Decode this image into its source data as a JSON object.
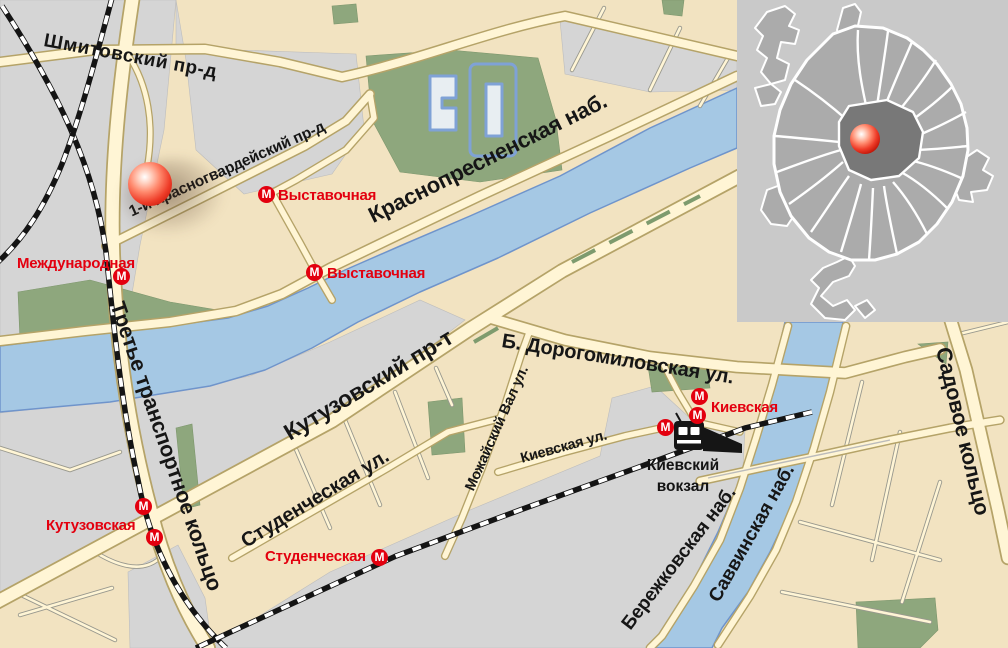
{
  "map": {
    "street_labels": [
      "Шмитовский пр-д",
      "1-й Красногвардейский пр-д",
      "Краснопресненская наб.",
      "Кутузовский пр-т",
      "Б. Дорогомиловская ул.",
      "Студенческая ул.",
      "Можайский Вал ул.",
      "Киевская ул.",
      "Третье транспортное кольцо",
      "Бережковская наб.",
      "Саввинская наб.",
      "Садовое кольцо"
    ],
    "metro": {
      "icon_letter": "М",
      "stations": [
        {
          "name": "Выставочная"
        },
        {
          "name": "Выставочная"
        },
        {
          "name": "Международная"
        },
        {
          "name": "Кутузовская"
        },
        {
          "name": "Студенческая"
        },
        {
          "name": "Киевская"
        }
      ]
    },
    "poi": {
      "rail_terminal": "Киевский\nвокзал"
    },
    "colors": {
      "metro_red": "#e3000f",
      "marker_red": "#e23322",
      "river_blue": "#a5c8e4",
      "river_edge": "#6f94cb",
      "park_green": "#8ea77d",
      "road_cream": "#fff5d5",
      "road_casing": "#b5a368",
      "block_beige": "#f2e3c1",
      "block_gray": "#d5d5d5",
      "inset_gray": "#c9c9c9",
      "railway_black": "#141414"
    }
  }
}
